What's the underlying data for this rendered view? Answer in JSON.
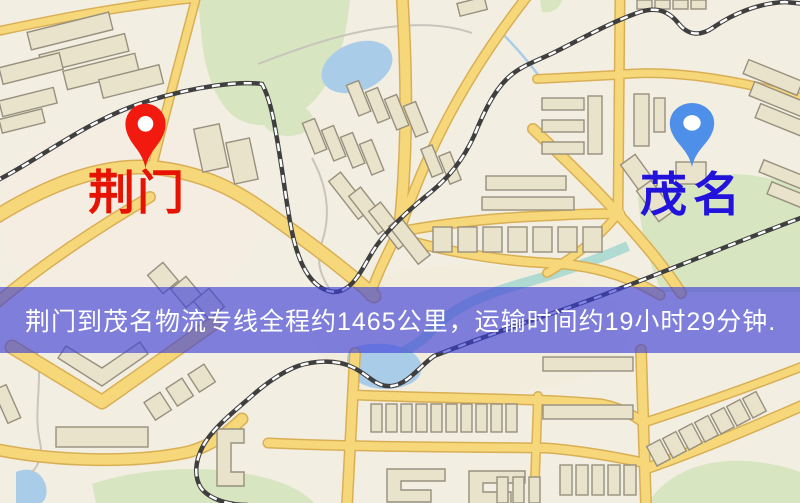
{
  "banner": {
    "text": "荆门到茂名物流专线全程约1465公里，运输时间约19小时29分钟.",
    "background_color": "#3a3ed7",
    "text_color": "#ffffff"
  },
  "origin": {
    "name": "荆门",
    "marker_color": "#f2190e",
    "label_color": "#e81202",
    "icon": "map-pin-icon"
  },
  "destination": {
    "name": "茂名",
    "marker_color": "#4e8fe9",
    "label_color": "#2113dc",
    "icon": "map-pin-icon"
  },
  "route": {
    "distance_text": "约1465公里",
    "duration_text": "约19小时29分钟"
  }
}
